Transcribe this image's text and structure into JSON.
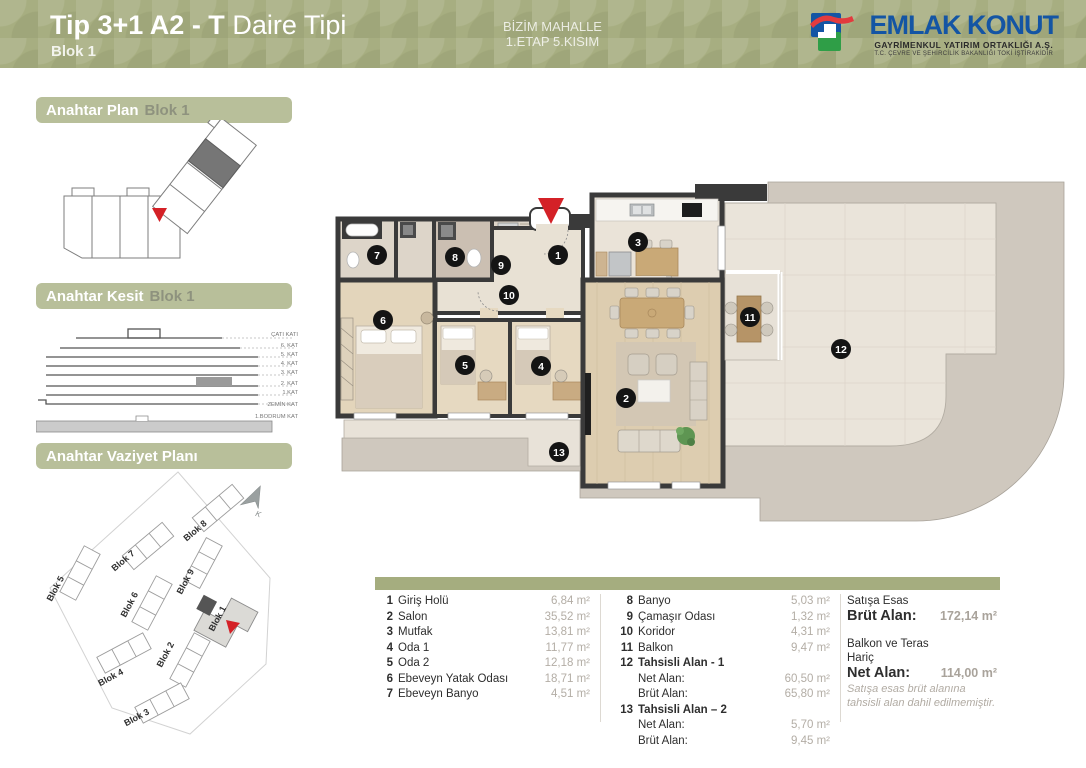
{
  "colors": {
    "header_olive": "#a7ae81",
    "section_bar": "#b8bf9a",
    "accent_red": "#d42127",
    "logo_blue": "#1455a4",
    "logo_red": "#e23b3e",
    "logo_green": "#2f9e47",
    "wall_dark": "#3a3a3a",
    "roof_band": "#cfc8be"
  },
  "header": {
    "title_bold": "Tip 3+1 A2 - T",
    "title_rest": " Daire Tipi",
    "subtitle": "Blok 1",
    "project_line1": "BİZİM MAHALLE",
    "project_line2": "1.ETAP 5.KISIM",
    "logo": {
      "name": "EMLAK KONUT",
      "line1": "GAYRİMENKUL YATIRIM ORTAKLIĞI A.Ş.",
      "line2": "T.C. ÇEVRE VE ŞEHİRCİLİK BAKANLIĞI TOKİ İŞTİRAKİDİR"
    }
  },
  "sidebar": {
    "key_plan": {
      "title": "Anahtar Plan",
      "subtitle": "Blok 1"
    },
    "key_section": {
      "title": "Anahtar Kesit",
      "subtitle": "Blok 1",
      "floors": [
        "ÇATI KATI",
        "6. KAT",
        "5. KAT",
        "4. KAT",
        "3. KAT",
        "2. KAT",
        "1.KAT",
        "ZEMİN KAT",
        "1.BODRUM KAT"
      ]
    },
    "site_plan": {
      "title": "Anahtar Vaziyet Planı",
      "blocks": [
        "Blok 1",
        "Blok 2",
        "Blok 3",
        "Blok 4",
        "Blok 5",
        "Blok 6",
        "Blok 7",
        "Blok 8",
        "Blok 9"
      ],
      "north_label": "K"
    }
  },
  "floor_plan": {
    "units": [
      "1",
      "2",
      "3",
      "4",
      "5",
      "6",
      "7",
      "8",
      "9",
      "10",
      "11",
      "12",
      "13"
    ]
  },
  "table": {
    "left_rooms": [
      {
        "no": "1",
        "name": "Giriş Holü",
        "area": "6,84 m²"
      },
      {
        "no": "2",
        "name": "Salon",
        "area": "35,52 m²"
      },
      {
        "no": "3",
        "name": "Mutfak",
        "area": "13,81 m²"
      },
      {
        "no": "4",
        "name": "Oda 1",
        "area": "11,77 m²"
      },
      {
        "no": "5",
        "name": "Oda 2",
        "area": "12,18 m²"
      },
      {
        "no": "6",
        "name": "Ebeveyn Yatak Odası",
        "area": "18,71 m²"
      },
      {
        "no": "7",
        "name": "Ebeveyn Banyo",
        "area": "4,51 m²"
      }
    ],
    "mid_rooms": [
      {
        "no": "8",
        "name": "Banyo",
        "area": "5,03 m²"
      },
      {
        "no": "9",
        "name": "Çamaşır Odası",
        "area": "1,32 m²"
      },
      {
        "no": "10",
        "name": "Koridor",
        "area": "4,31 m²"
      },
      {
        "no": "11",
        "name": "Balkon",
        "area": "9,47 m²"
      },
      {
        "no": "12",
        "name": "Tahsisli Alan - 1",
        "area": ""
      },
      {
        "label": "Net Alan:",
        "area": "60,50 m²"
      },
      {
        "label": "Brüt Alan:",
        "area": "65,80 m²"
      },
      {
        "no": "13",
        "name": "Tahsisli Alan – 2",
        "area": ""
      },
      {
        "label": "Net Alan:",
        "area": "5,70 m²"
      },
      {
        "label": "Brüt Alan:",
        "area": "9,45 m²"
      }
    ],
    "summary": {
      "line1": "Satışa Esas",
      "brut_label": "Brüt Alan:",
      "brut_value": "172,14 m²",
      "line2a": "Balkon ve Teras",
      "line2b": "Hariç",
      "net_label": "Net Alan:",
      "net_value": "114,00 m²",
      "note1": "Satışa esas brüt alanına",
      "note2": "tahsisli alan dahil edilmemiştir."
    }
  }
}
